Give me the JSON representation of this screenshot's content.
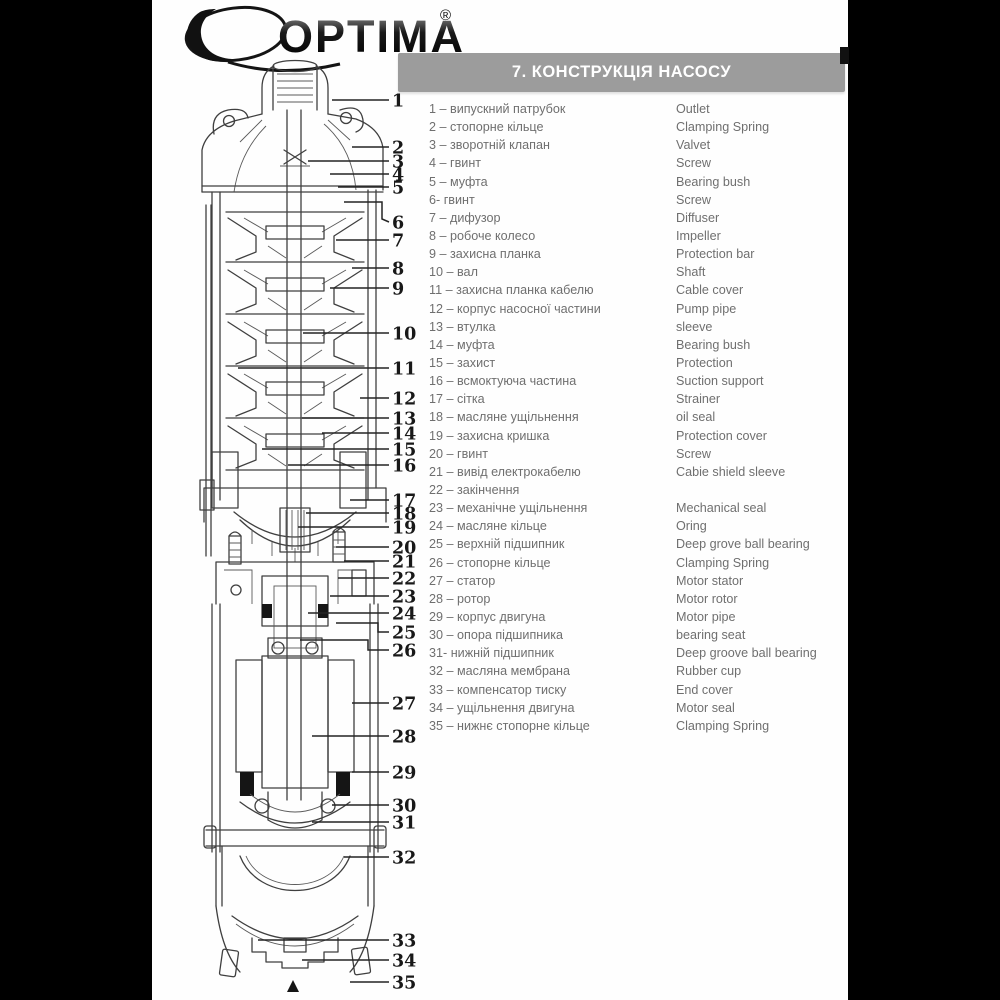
{
  "logo": {
    "text": "OPTIMA",
    "registered_mark": "®"
  },
  "header": {
    "title": "7. КОНСТРУКЦІЯ НАСОСУ"
  },
  "colors": {
    "header_bar": "#9c9c9c",
    "list_text": "#6f6f6f",
    "letterbox": "#000000",
    "line": "#3f3f3f"
  },
  "parts_list": {
    "items": [
      {
        "num": "1",
        "uk": "1 – випускний патрубок",
        "en": "Outlet"
      },
      {
        "num": "2",
        "uk": "2 – стопорне кільце",
        "en": "Clamping Spring"
      },
      {
        "num": "3",
        "uk": "3 – зворотній клапан",
        "en": "Valvet"
      },
      {
        "num": "4",
        "uk": "4 – гвинт",
        "en": "Screw"
      },
      {
        "num": "5",
        "uk": "5 – муфта",
        "en": "Bearing bush"
      },
      {
        "num": "6",
        "uk": "6- гвинт",
        "en": "Screw"
      },
      {
        "num": "7",
        "uk": "7 – дифузор",
        "en": "Diffuser"
      },
      {
        "num": "8",
        "uk": "8 – робоче колесо",
        "en": "Impeller"
      },
      {
        "num": "9",
        "uk": "9 – захисна планка",
        "en": "Protection bar"
      },
      {
        "num": "10",
        "uk": "10 – вал",
        "en": "Shaft"
      },
      {
        "num": "11",
        "uk": "11 – захисна планка кабелю",
        "en": "Cable cover"
      },
      {
        "num": "12",
        "uk": "12 – корпус насосної частини",
        "en": "Pump pipe"
      },
      {
        "num": "13",
        "uk": "13 – втулка",
        "en": "sleeve"
      },
      {
        "num": "14",
        "uk": "14 – муфта",
        "en": "Bearing bush"
      },
      {
        "num": "15",
        "uk": "15 – захист",
        "en": "Protection"
      },
      {
        "num": "16",
        "uk": "16 – всмоктуюча частина",
        "en": "Suction support"
      },
      {
        "num": "17",
        "uk": "17 – сітка",
        "en": "Strainer"
      },
      {
        "num": "18",
        "uk": "18 – масляне ущільнення",
        "en": "oil seal"
      },
      {
        "num": "19",
        "uk": "19 – захисна кришка",
        "en": "Protection cover"
      },
      {
        "num": "20",
        "uk": "20 – гвинт",
        "en": "Screw"
      },
      {
        "num": "21",
        "uk": "21 – вивід електрокабелю",
        "en": "Cabie shield sleeve"
      },
      {
        "num": "22",
        "uk": "22 – закінчення",
        "en": ""
      },
      {
        "num": "23",
        "uk": "23 – механічне ущільнення",
        "en": "Mechanical seal"
      },
      {
        "num": "24",
        "uk": "24 – масляне кільце",
        "en": "Oring"
      },
      {
        "num": "25",
        "uk": "25 – верхній підшипник",
        "en": "Deep grove ball bearing"
      },
      {
        "num": "26",
        "uk": "26 – стопорне кільце",
        "en": "Clamping Spring"
      },
      {
        "num": "27",
        "uk": "27 – статор",
        "en": "Motor stator"
      },
      {
        "num": "28",
        "uk": "28 – ротор",
        "en": "Motor rotor"
      },
      {
        "num": "29",
        "uk": "29 – корпус двигуна",
        "en": "Motor pipe"
      },
      {
        "num": "30",
        "uk": "30 – опора підшипника",
        "en": "bearing seat"
      },
      {
        "num": "31",
        "uk": "31- нижній підшипник",
        "en": "Deep groove ball bearing"
      },
      {
        "num": "32",
        "uk": "32 – масляна мембрана",
        "en": "Rubber cup"
      },
      {
        "num": "33",
        "uk": "33 – компенсатор тиску",
        "en": "End cover"
      },
      {
        "num": "34",
        "uk": "34 – ущільнення двигуна",
        "en": "Motor seal"
      },
      {
        "num": "35",
        "uk": "35 – нижнє стопорне кільце",
        "en": "Clamping Spring"
      }
    ]
  },
  "diagram": {
    "bottom_marker": "▲",
    "callouts": [
      {
        "n": "1",
        "y": 100,
        "tx": 332
      },
      {
        "n": "2",
        "y": 147,
        "tx": 352
      },
      {
        "n": "3",
        "y": 161,
        "tx": 308
      },
      {
        "n": "4",
        "y": 174,
        "tx": 330
      },
      {
        "n": "5",
        "y": 187,
        "tx": 338
      },
      {
        "n": "6",
        "y": 222,
        "path": [
          [
            344,
            202
          ],
          [
            382,
            202
          ],
          [
            382,
            219
          ],
          [
            389,
            222
          ]
        ]
      },
      {
        "n": "7",
        "y": 240,
        "tx": 336
      },
      {
        "n": "8",
        "y": 268,
        "tx": 352
      },
      {
        "n": "9",
        "y": 288,
        "tx": 330
      },
      {
        "n": "10",
        "y": 333,
        "tx": 303
      },
      {
        "n": "11",
        "y": 368,
        "tx": 238
      },
      {
        "n": "12",
        "y": 398,
        "tx": 360
      },
      {
        "n": "13",
        "y": 418,
        "tx": 302
      },
      {
        "n": "14",
        "y": 433,
        "tx": 322
      },
      {
        "n": "15",
        "y": 449,
        "tx": 262
      },
      {
        "n": "16",
        "y": 465,
        "tx": 288
      },
      {
        "n": "17",
        "y": 500,
        "tx": 350
      },
      {
        "n": "18",
        "y": 513,
        "tx": 306
      },
      {
        "n": "19",
        "y": 527,
        "tx": 298
      },
      {
        "n": "20",
        "y": 547,
        "tx": 336
      },
      {
        "n": "21",
        "y": 561,
        "tx": 344
      },
      {
        "n": "22",
        "y": 578,
        "tx": 338
      },
      {
        "n": "23",
        "y": 596,
        "tx": 330
      },
      {
        "n": "24",
        "y": 613,
        "tx": 308
      },
      {
        "n": "25",
        "y": 632,
        "path": [
          [
            336,
            623
          ],
          [
            378,
            623
          ],
          [
            378,
            632
          ],
          [
            389,
            632
          ]
        ]
      },
      {
        "n": "26",
        "y": 650,
        "path": [
          [
            300,
            640
          ],
          [
            368,
            640
          ],
          [
            368,
            650
          ],
          [
            389,
            650
          ]
        ]
      },
      {
        "n": "27",
        "y": 703,
        "tx": 352
      },
      {
        "n": "28",
        "y": 736,
        "tx": 312
      },
      {
        "n": "29",
        "y": 772,
        "tx": 352
      },
      {
        "n": "30",
        "y": 805,
        "tx": 332
      },
      {
        "n": "31",
        "y": 822,
        "tx": 312
      },
      {
        "n": "32",
        "y": 857,
        "tx": 344
      },
      {
        "n": "33",
        "y": 940,
        "tx": 258
      },
      {
        "n": "34",
        "y": 960,
        "tx": 302
      },
      {
        "n": "35",
        "y": 982,
        "tx": 350
      }
    ]
  }
}
